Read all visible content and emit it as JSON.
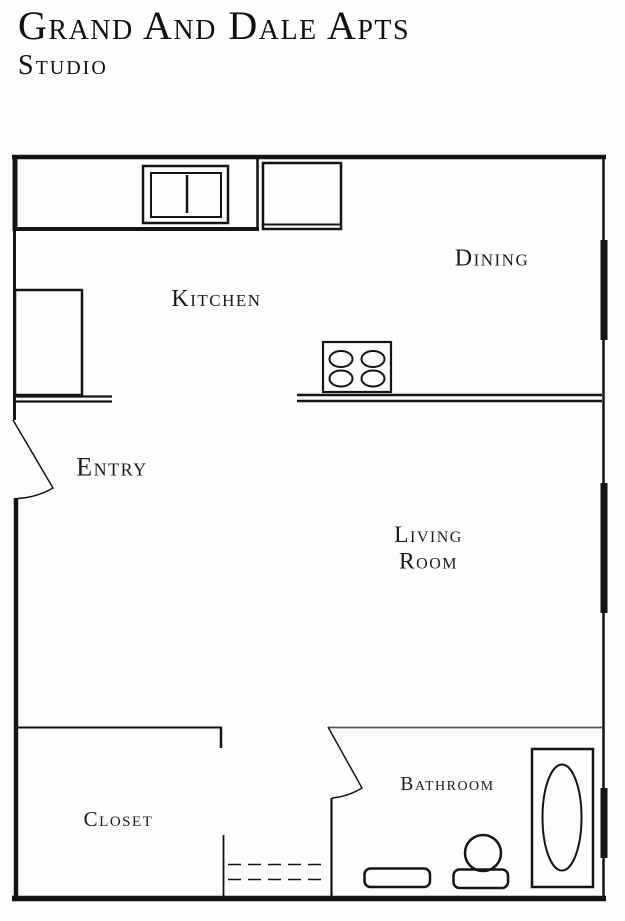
{
  "header": {
    "title": "Grand And Dale Apts",
    "subtitle": "Studio"
  },
  "plan": {
    "labels": {
      "kitchen": "Kitchen",
      "dining": "Dining",
      "entry": "Entry",
      "living_room_line1": "Living",
      "living_room_line2": "Room",
      "closet": "Closet",
      "bathroom": "Bathroom"
    }
  },
  "colors": {
    "line": "#141414",
    "background": "#fdfdfc",
    "interior_wall_gray": "#555555"
  }
}
